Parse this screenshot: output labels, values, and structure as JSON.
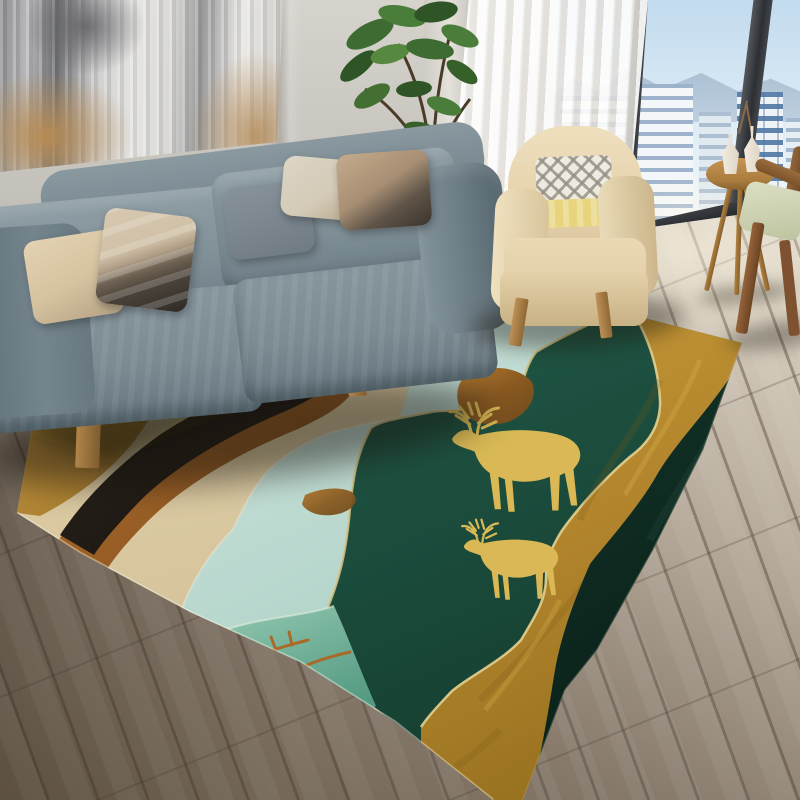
{
  "scene": {
    "description": "Photographic living-room scene showcasing an abstract area rug with golden deer; no text rendered in image",
    "room": {
      "wall": "light warm gray with corner shading",
      "artwork": "abstract painting, gray-white brushwork with gold patches, top-left, cropped by frame edges",
      "window": "floor-to-ceiling glass, right side, dark mullions, city skyline of white towers, distant blue mountains, pale blue sky",
      "curtain": "white sheer panel between wall pier and window",
      "floor": "wood planks, sunlit light beige near window fading to dark gray-brown at lower left"
    },
    "furniture": [
      {
        "name": "sofa",
        "color_hex": "#7b8b92",
        "details": "gray-blue fabric, wooden base and legs, five throw pillows (beige, taupe geometric, gray-blue, cream, brown-block)"
      },
      {
        "name": "armchair",
        "color_hex": "#e5d2ac",
        "details": "cream barrel chair, chevron pillow with pale yellow band, splayed wood legs"
      },
      {
        "name": "side-table",
        "color_hex": "#aa7c3e",
        "details": "round wooden tripod table with two white bottle vases and dry sprig"
      },
      {
        "name": "wooden-chair",
        "color_hex": "#8a5a34",
        "details": "partial wooden chair with sage cushion at right edge"
      },
      {
        "name": "potted-plant",
        "color_hex": "#46772f",
        "details": "leafy green plant in dark gray planter behind sofa right end"
      }
    ],
    "rug": {
      "style": "abstract layered mountain landscape, perspective view",
      "motif": "two golden elk/deer silhouettes with antlers standing on emerald band",
      "bands_back_to_front": [
        {
          "name": "mustard-corner-patch",
          "hex": "#b98a35"
        },
        {
          "name": "black-sweep",
          "hex": "#221c16"
        },
        {
          "name": "copper-edge",
          "hex": "#a4621f"
        },
        {
          "name": "sand-field",
          "hex": "#d8c69e"
        },
        {
          "name": "mint-band",
          "hex": "#c3ded5"
        },
        {
          "name": "jade-patch-with-copper-branches",
          "hex": "#7cbBa2"
        },
        {
          "name": "emerald-band",
          "hex": "#1c5240"
        },
        {
          "name": "gold-band",
          "hex": "#b98c2f"
        },
        {
          "name": "near-black-green-band",
          "hex": "#0e2a21"
        }
      ],
      "deer_color_hex": "#d9b855",
      "edging_color_hex": "#d8c788"
    },
    "palette": {
      "wall": "#c6c3bd",
      "floor_light": "#e4ddcd",
      "floor_dark": "#655848",
      "sky": "#cfe2f1",
      "mountains": "#a4bacf",
      "buildings": "#eef2f6",
      "window_frame": "#2c2f33",
      "sunlight": "#fff8e6"
    }
  }
}
